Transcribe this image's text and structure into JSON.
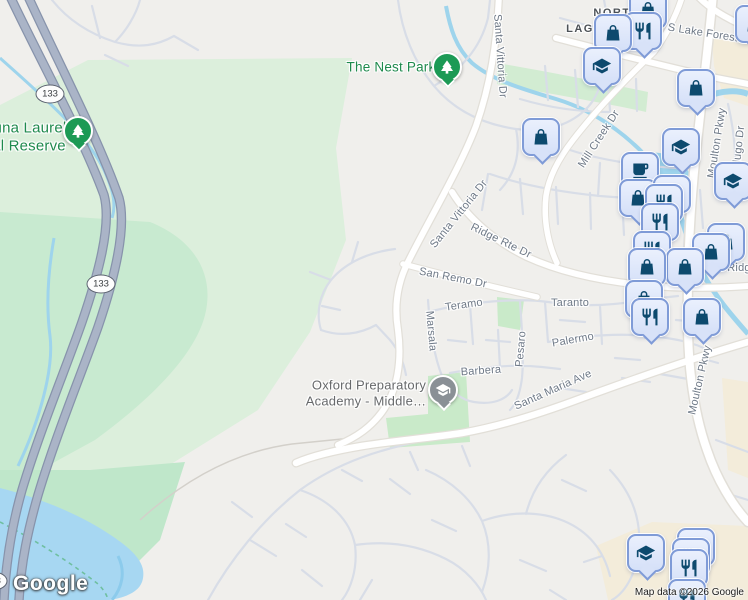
{
  "map": {
    "logo_text": "Google",
    "attribution": "Map data ©2026 Google",
    "labels": [
      {
        "kind": "road",
        "t": "S Lake Forest",
        "x": 703,
        "y": 33,
        "r": 9
      },
      {
        "kind": "road",
        "t": "Santa Vittoria Dr",
        "x": 500,
        "y": 56,
        "r": 86
      },
      {
        "kind": "road",
        "t": "Mill Creek Dr",
        "x": 599,
        "y": 139,
        "r": -57
      },
      {
        "kind": "road",
        "t": "Moulton Pkwy",
        "x": 717,
        "y": 143,
        "r": -81
      },
      {
        "kind": "road",
        "t": "dugo Dr",
        "x": 739,
        "y": 146,
        "r": -84
      },
      {
        "kind": "road",
        "t": "Santa Vittoria Dr",
        "x": 459,
        "y": 214,
        "r": -51
      },
      {
        "kind": "road",
        "t": "Ridge Rte Dr",
        "x": 501,
        "y": 241,
        "r": 26
      },
      {
        "kind": "road",
        "t": "San Remo Dr",
        "x": 453,
        "y": 278,
        "r": 11
      },
      {
        "kind": "road",
        "t": "Teramo",
        "x": 464,
        "y": 305,
        "r": -8
      },
      {
        "kind": "road",
        "t": "Taranto",
        "x": 570,
        "y": 303,
        "r": 0
      },
      {
        "kind": "road",
        "t": "Marsala",
        "x": 431,
        "y": 331,
        "r": 85
      },
      {
        "kind": "road",
        "t": "Pesaro",
        "x": 521,
        "y": 349,
        "r": -85
      },
      {
        "kind": "road",
        "t": "Palermo",
        "x": 573,
        "y": 340,
        "r": -10
      },
      {
        "kind": "road",
        "t": "Barbera",
        "x": 481,
        "y": 371,
        "r": -4
      },
      {
        "kind": "road",
        "t": "Santa Maria Ave",
        "x": 553,
        "y": 390,
        "r": -24
      },
      {
        "kind": "road",
        "t": "Moulton Pkwy",
        "x": 700,
        "y": 380,
        "r": -77
      },
      {
        "kind": "road",
        "t": "Ridg",
        "x": 739,
        "y": 268,
        "r": 0
      },
      {
        "kind": "area",
        "t": "NORT",
        "x": 612,
        "y": 13,
        "r": 0
      },
      {
        "kind": "area",
        "t": "LAG",
        "x": 580,
        "y": 29,
        "r": 0
      },
      {
        "kind": "park",
        "t": "The Nest Park",
        "x": 391,
        "y": 67,
        "r": 0,
        "s": 13.5
      },
      {
        "kind": "park",
        "t": "una Laurel",
        "x": 30,
        "y": 128,
        "r": 0,
        "s": 15
      },
      {
        "kind": "park",
        "t": "al Reserve",
        "x": 29,
        "y": 146,
        "r": 0,
        "s": 15
      },
      {
        "kind": "poi",
        "t": "Oxford Preparatory",
        "x": 369,
        "y": 385,
        "r": 0
      },
      {
        "kind": "poi",
        "t": "Academy - Middle…",
        "x": 366,
        "y": 401,
        "r": 0
      }
    ],
    "shields": [
      {
        "t": "133",
        "x": 50,
        "y": 94
      },
      {
        "t": "133",
        "x": 101,
        "y": 284
      },
      {
        "t": "133",
        "x": -7,
        "y": 581
      }
    ],
    "markers": [
      {
        "icon": "shopping-bag",
        "x": 648,
        "y": 10
      },
      {
        "icon": "restaurant",
        "x": 643,
        "y": 31
      },
      {
        "icon": "shopping-bag",
        "x": 613,
        "y": 33
      },
      {
        "icon": "graduation-cap",
        "x": 602,
        "y": 66
      },
      {
        "icon": "shopping-bag",
        "x": 754,
        "y": 24
      },
      {
        "icon": "shopping-bag",
        "x": 541,
        "y": 137
      },
      {
        "icon": "shopping-bag",
        "x": 696,
        "y": 88
      },
      {
        "icon": "graduation-cap",
        "x": 681,
        "y": 147
      },
      {
        "icon": "graduation-cap",
        "x": 733,
        "y": 181
      },
      {
        "icon": "coffee",
        "x": 640,
        "y": 171
      },
      {
        "icon": "shopping-bag",
        "x": 638,
        "y": 198
      },
      {
        "icon": "restaurant",
        "x": 672,
        "y": 194
      },
      {
        "icon": "restaurant",
        "x": 664,
        "y": 203
      },
      {
        "icon": "restaurant",
        "x": 660,
        "y": 222
      },
      {
        "icon": "shopping-bag",
        "x": 726,
        "y": 242
      },
      {
        "icon": "restaurant",
        "x": 652,
        "y": 250
      },
      {
        "icon": "shopping-bag",
        "x": 711,
        "y": 252
      },
      {
        "icon": "shopping-bag",
        "x": 685,
        "y": 267
      },
      {
        "icon": "shopping-bag",
        "x": 647,
        "y": 267
      },
      {
        "icon": "shopping-bag",
        "x": 644,
        "y": 299
      },
      {
        "icon": "restaurant",
        "x": 650,
        "y": 317
      },
      {
        "icon": "shopping-bag",
        "x": 702,
        "y": 317
      },
      {
        "icon": "restaurant",
        "x": 696,
        "y": 547
      },
      {
        "icon": "restaurant",
        "x": 691,
        "y": 557
      },
      {
        "icon": "restaurant",
        "x": 689,
        "y": 568
      },
      {
        "icon": "restaurant",
        "x": 687,
        "y": 598
      },
      {
        "icon": "graduation-cap",
        "x": 646,
        "y": 553
      },
      {
        "icon": "tree",
        "x": 447,
        "y": 67
      },
      {
        "icon": "tree",
        "x": 78,
        "y": 131
      },
      {
        "icon": "school",
        "x": 443,
        "y": 390
      }
    ],
    "colors": {
      "background": "#f0efec",
      "reserve_green": "#dcefdc",
      "water": "#a7d7f2",
      "commercial": "#f3ecda",
      "toll_road": "#aab4c7",
      "road_label": "#6e7987",
      "park_label": "#1f8a4d",
      "marker_fill": "#dce6fa",
      "marker_border": "#7f9bd7",
      "marker_icon": "#0d4a6e",
      "park_marker": "#1c9a55",
      "school_marker": "#8a9096"
    }
  }
}
